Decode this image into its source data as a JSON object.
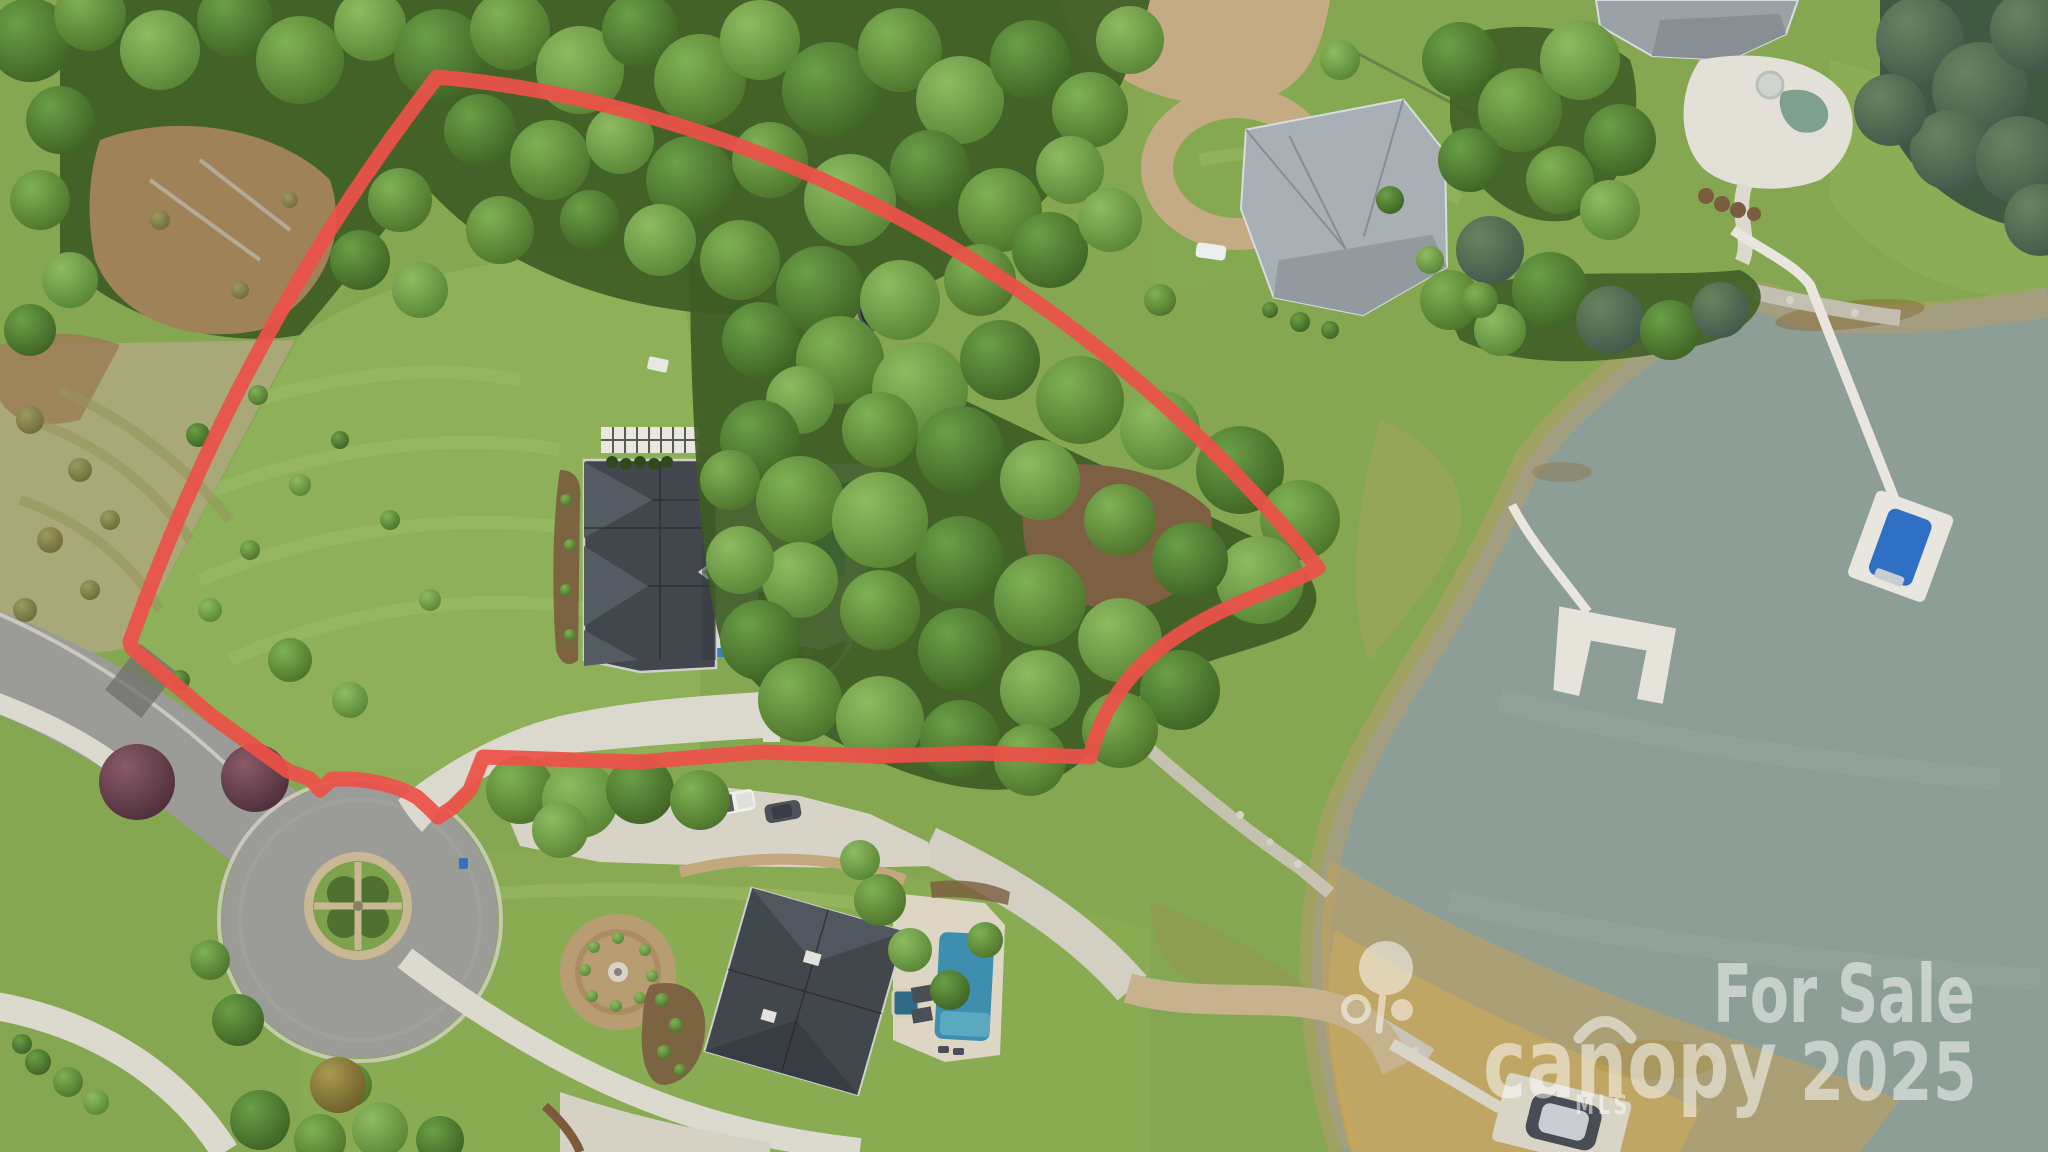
{
  "photo": {
    "kind": "aerial-drone-photo",
    "subject": "Waterfront residential lot for sale outlined in red"
  },
  "watermark": {
    "for_sale_label": "For Sale",
    "year_label": "2025",
    "brand_name": "canopy",
    "brand_suffix": "MLS",
    "brand_icon": "canopy-tree-icon",
    "text_color": "#ffffff"
  },
  "boundary": {
    "outline_color": "#ee5048"
  },
  "palette": {
    "water": "#8d9e96",
    "grass": "#86a751",
    "asphalt": "#9b9b97",
    "concrete": "#dcd9cf",
    "sand": "#c2a36b",
    "dark_roof": "#42474e",
    "light_roof": "#a8b0b5",
    "pool": "#3fa6c9"
  }
}
